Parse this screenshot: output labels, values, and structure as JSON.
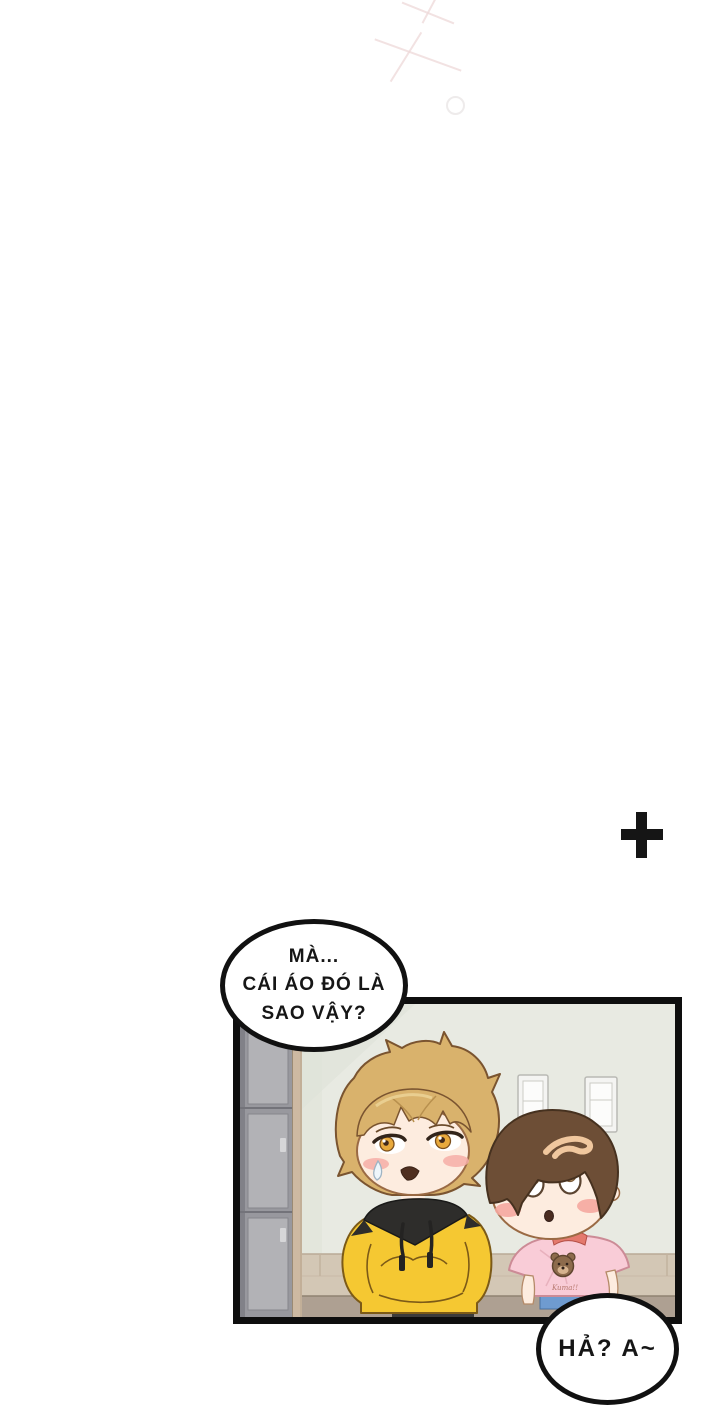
{
  "page": {
    "kind": "webtoon comic page",
    "background_color": "#ffffff"
  },
  "decorations": {
    "plus_mark": {
      "symbol": "+",
      "color": "#151515"
    },
    "sparkle_color": "#eed8d8"
  },
  "bubbles": {
    "top": {
      "line1": "MÀ...",
      "line2": "CÁI ÁO ĐÓ LÀ",
      "line3": "SAO VẬY?"
    },
    "bottom": {
      "text": "HẢ? A~"
    }
  },
  "panel": {
    "border_color": "#0e0e0e",
    "colors": {
      "wall": "#e8eae2",
      "locker_gray": "#98989e",
      "door_frame_tan": "#cdb9a2",
      "tile_band": "#d3c7b5",
      "floor": "#aea092",
      "hoodie_yellow": "#f5c832",
      "hood_black": "#2e2d2b",
      "hair_blonde": "#d9b26c",
      "hair_brown": "#6d4e36",
      "shirt_pink": "#f9ccd7",
      "skin": "#fdecdf",
      "blush": "#f5a8a0",
      "jeans_blue": "#6f9bd0"
    },
    "characters": {
      "left": {
        "description": "blonde boy in yellow hoodie, hands in pocket, sweat drop"
      },
      "right": {
        "description": "brown-haired boy in pink teddy-bear t-shirt",
        "shirt_text": "Kuma!!"
      }
    }
  }
}
